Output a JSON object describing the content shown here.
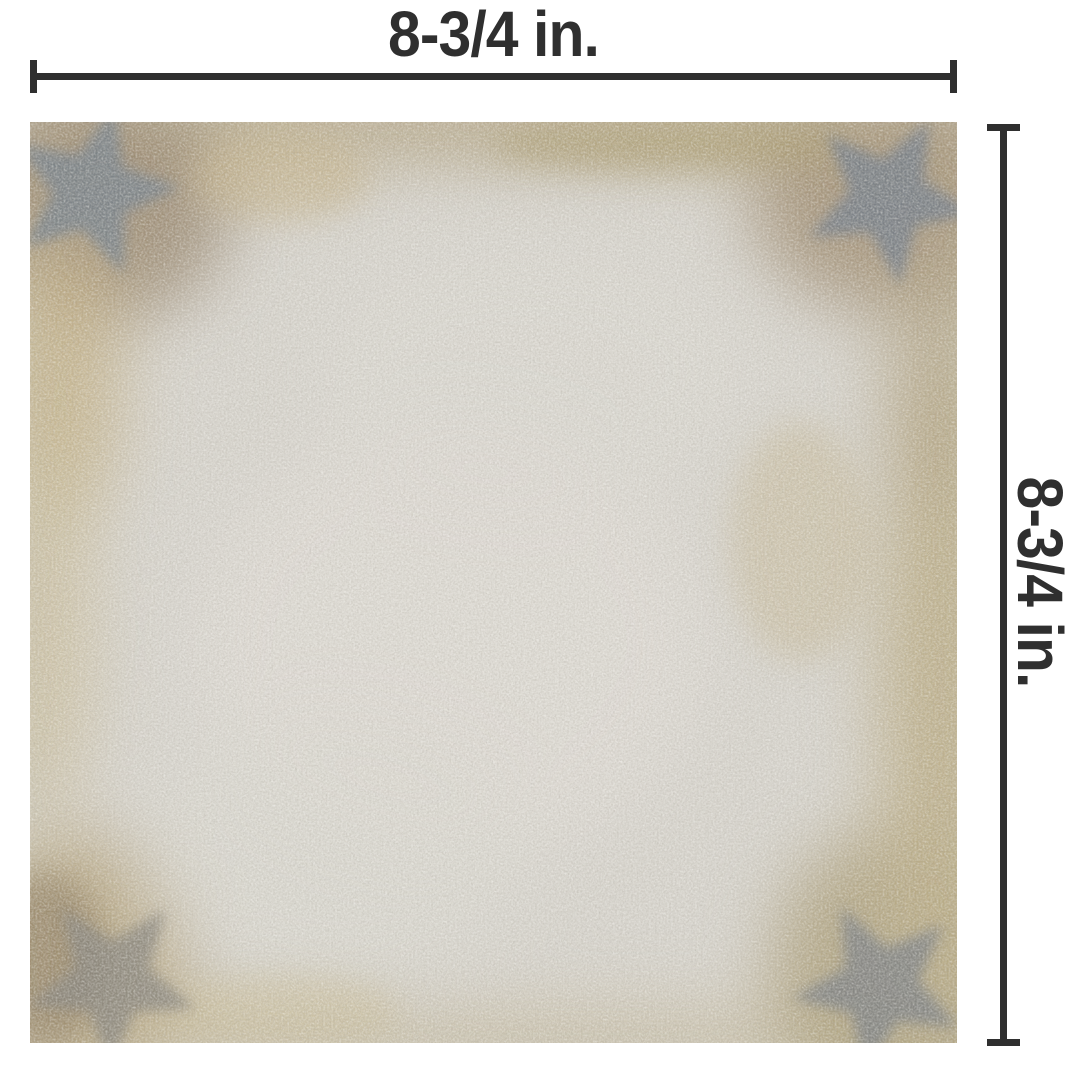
{
  "diagram": {
    "type": "product-dimension-diagram",
    "subject": "distressed vintage-look square tile swatch",
    "width_dimension": {
      "label": "8-3/4 in."
    },
    "height_dimension": {
      "label": "8-3/4 in."
    },
    "colors": {
      "annotation": "#2f2f2f",
      "canvas_background": "#ffffff",
      "tile_base_gray": "#d7d4cd",
      "tile_stain_tan": "#bcae87",
      "tile_corner_brown": "#9a8870",
      "corner_motif_gray": "#75808a"
    }
  }
}
